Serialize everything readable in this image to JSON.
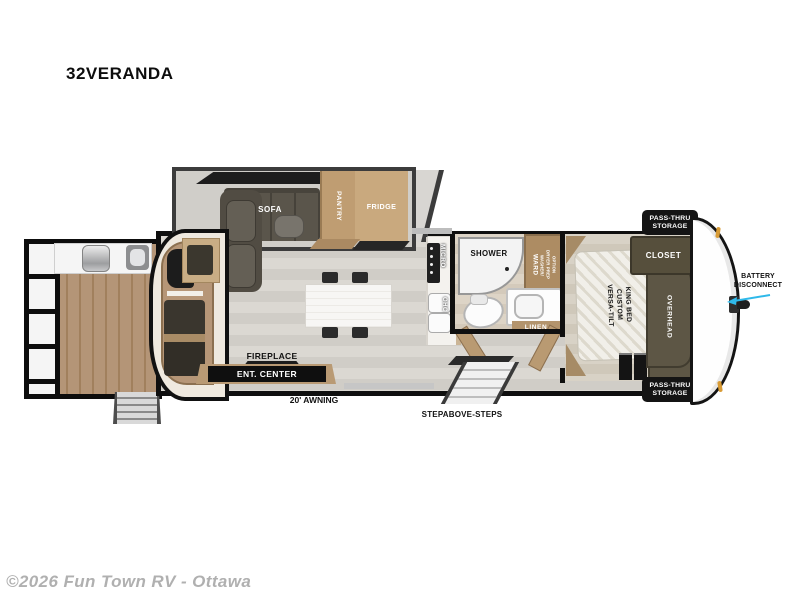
{
  "title": "32VERANDA",
  "watermark": "©2026 Fun Town RV - Ottawa",
  "colors": {
    "wall": "#0f0f0f",
    "cabinet_tan": "#bf9d72",
    "sofa": "#5a554b",
    "dark_cabinet": "#5d5645",
    "floor_main": "#d6d3cd",
    "deck_wood": "#ab8a64",
    "badge_bg": "#141414",
    "battery_arrow": "#2fb9ea",
    "marker_light": "#d89b35"
  },
  "rooms": {
    "sofa": "SOFA",
    "pantry": "PANTRY",
    "fridge": "FRIDGE",
    "micro": "MICRO",
    "ohc": "OHC",
    "shower": "SHOWER",
    "ward": {
      "main": "WARD",
      "sub1": "WASHER/",
      "sub2": "DRYER PREP",
      "sub3": "OPTION"
    },
    "linen": "LINEN",
    "closet": "CLOSET",
    "overhead": "OVERHEAD",
    "bed": {
      "line1": "VERSA-TILT",
      "line2": "CUSTOM",
      "line3": "KING BED"
    },
    "fireplace": "FIREPLACE",
    "ent_center": "ENT. CENTER"
  },
  "exterior": {
    "pass_thru_top": {
      "line1": "PASS-THRU",
      "line2": "STORAGE"
    },
    "pass_thru_bottom": {
      "line1": "PASS-THRU",
      "line2": "STORAGE"
    },
    "battery": {
      "line1": "BATTERY",
      "line2": "DISCONNECT"
    },
    "awning": "20' AWNING",
    "steps": "STEPABOVE-STEPS"
  }
}
